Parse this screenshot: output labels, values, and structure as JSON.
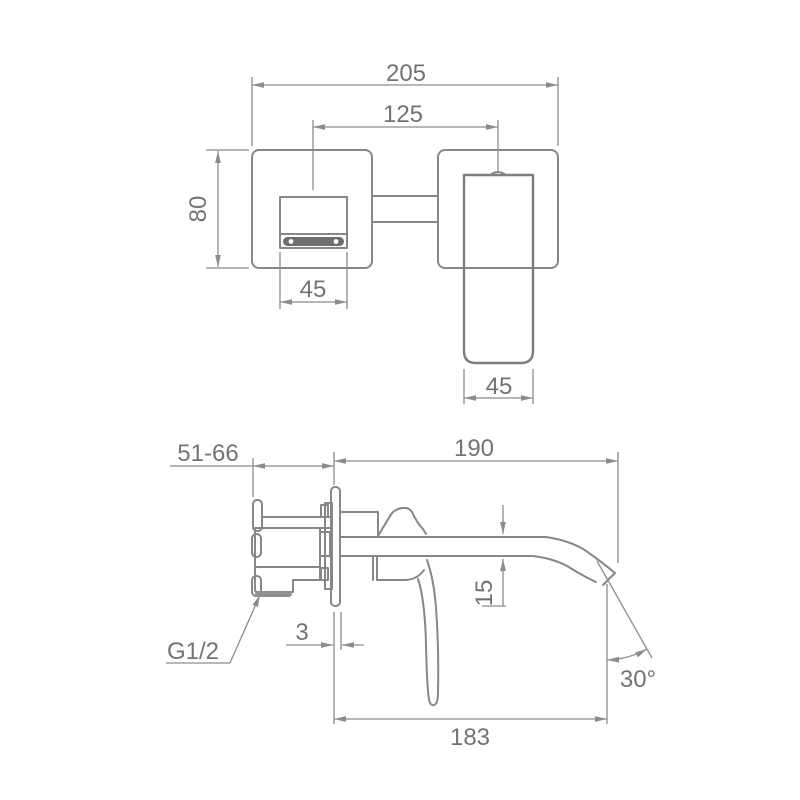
{
  "colors": {
    "background": "#ffffff",
    "object_line": "#85878a",
    "dimension_line": "#8a8c8e",
    "text": "#717477",
    "aerator_fill": "#6e6e6e",
    "thread_end_fill": "#8f9194"
  },
  "front_view": {
    "overall_width": "205",
    "spout_to_handle_centers": "125",
    "plate_height": "80",
    "spout_plate_width": "45",
    "handle_width": "45"
  },
  "side_view": {
    "installation_depth_range": "51-66",
    "spout_reach": "190",
    "spout_thickness": "15",
    "plate_offset": "3",
    "spout_projection": "183",
    "outlet_angle": "30°",
    "thread_label": "G1/2"
  }
}
